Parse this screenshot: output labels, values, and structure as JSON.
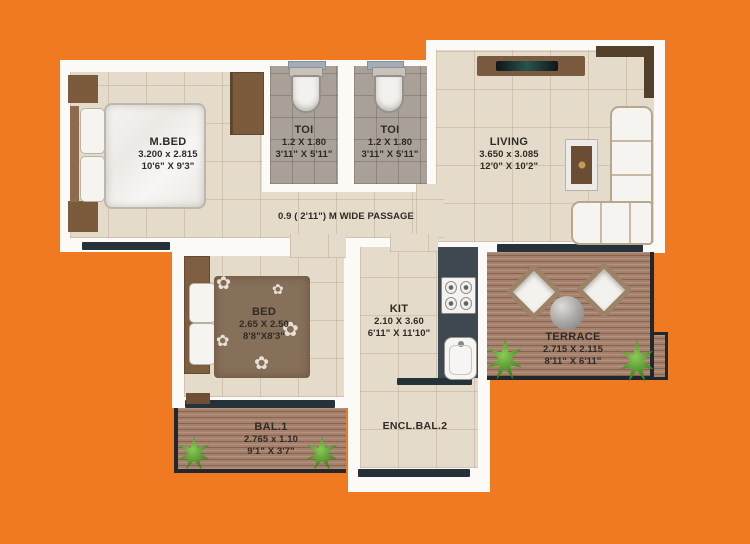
{
  "palette": {
    "background_orange": "#EF7A22",
    "wall_white": "#FBFAF6",
    "floor_beige": "#E5DBCB",
    "toilet_floor_gray": "#A9A197",
    "wood_deck": "#A5806B",
    "kitchen_counter": "#3E4851",
    "furniture_brown": "#7C5A3C",
    "window_sill_dark": "#26323A",
    "toilet_sill_blue": "#9FAEBA",
    "plant_green": "#4A9027"
  },
  "rooms": {
    "master_bedroom": {
      "name": "M.BED",
      "dimensions_m": "3.200 x 2.815",
      "dimensions_ft": "10'6\" X 9'3\""
    },
    "toilet_1": {
      "name": "TOI",
      "dimensions_m": "1.2 X 1.80",
      "dimensions_ft": "3'11\" X 5'11\""
    },
    "toilet_2": {
      "name": "TOI",
      "dimensions_m": "1.2 X 1.80",
      "dimensions_ft": "3'11\" X 5'11\""
    },
    "living": {
      "name": "LIVING",
      "dimensions_m": "3.650 x 3.085",
      "dimensions_ft": "12'0\" X 10'2\""
    },
    "passage": {
      "label": "0.9 ( 2'11\") M WIDE PASSAGE"
    },
    "bedroom": {
      "name": "BED",
      "dimensions_m": "2.65 X 2.50",
      "dimensions_ft": "8'8\"X8'3\""
    },
    "kitchen": {
      "name": "KIT",
      "dimensions_m": "2.10 X 3.60",
      "dimensions_ft": "6'11\" X 11'10\""
    },
    "terrace": {
      "name": "TERRACE",
      "dimensions_m": "2.715 X 2.115",
      "dimensions_ft": "8'11\" X 6'11\""
    },
    "balcony_1": {
      "name": "BAL.1",
      "dimensions_m": "2.765 x 1.10",
      "dimensions_ft": "9'1\" X 3'7\""
    },
    "enclosed_balcony_2": {
      "name": "ENCL.BAL.2"
    }
  },
  "decor": {
    "flower_glyph": "✿"
  }
}
